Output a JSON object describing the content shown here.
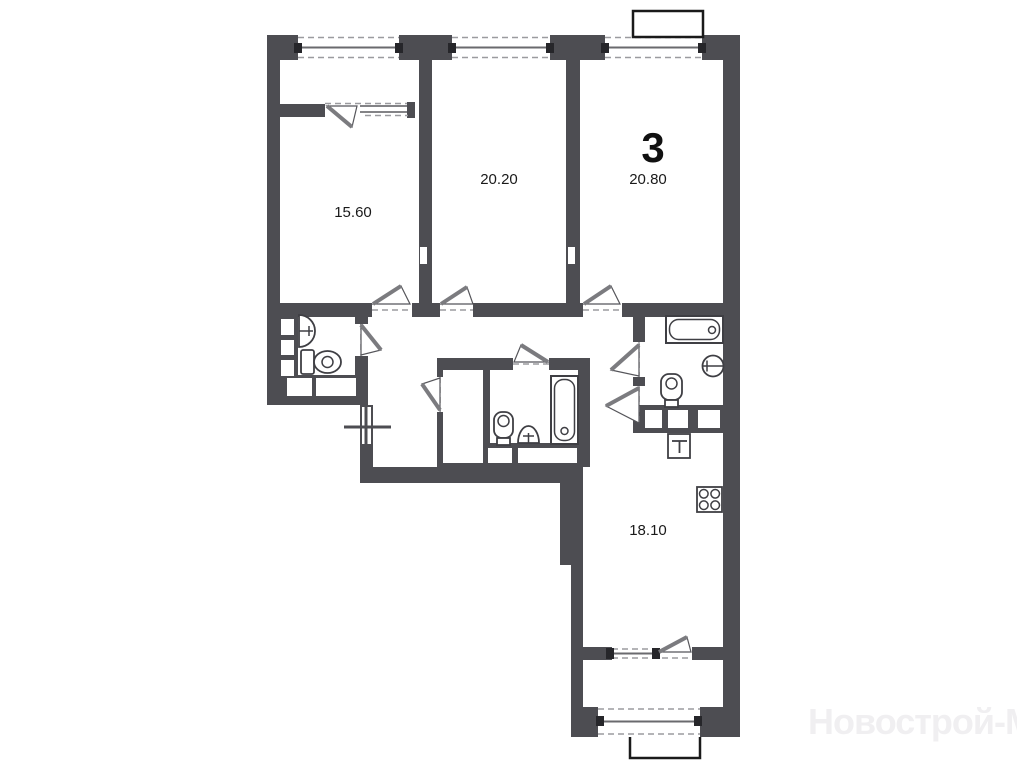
{
  "plan": {
    "apartment_number": "3",
    "rooms": [
      {
        "id": "room-1",
        "area_label": "15.60"
      },
      {
        "id": "room-2",
        "area_label": "20.20"
      },
      {
        "id": "room-3",
        "area_label": "20.80"
      },
      {
        "id": "kitchen",
        "area_label": "18.10"
      }
    ],
    "watermark_text": "Новострой-М",
    "fixtures": [
      "sink-icon",
      "toilet-icon",
      "bathtub-icon",
      "washer-icon",
      "stove-icon"
    ],
    "colors": {
      "background": "#ffffff",
      "wall": "#4d4d52",
      "dashed_line": "#9b9b9f",
      "door_leaf": "#7b7b7f",
      "fixture_stroke": "#3f3f44",
      "label_text": "#1a1a1a",
      "watermark": "#f0eff1"
    }
  }
}
